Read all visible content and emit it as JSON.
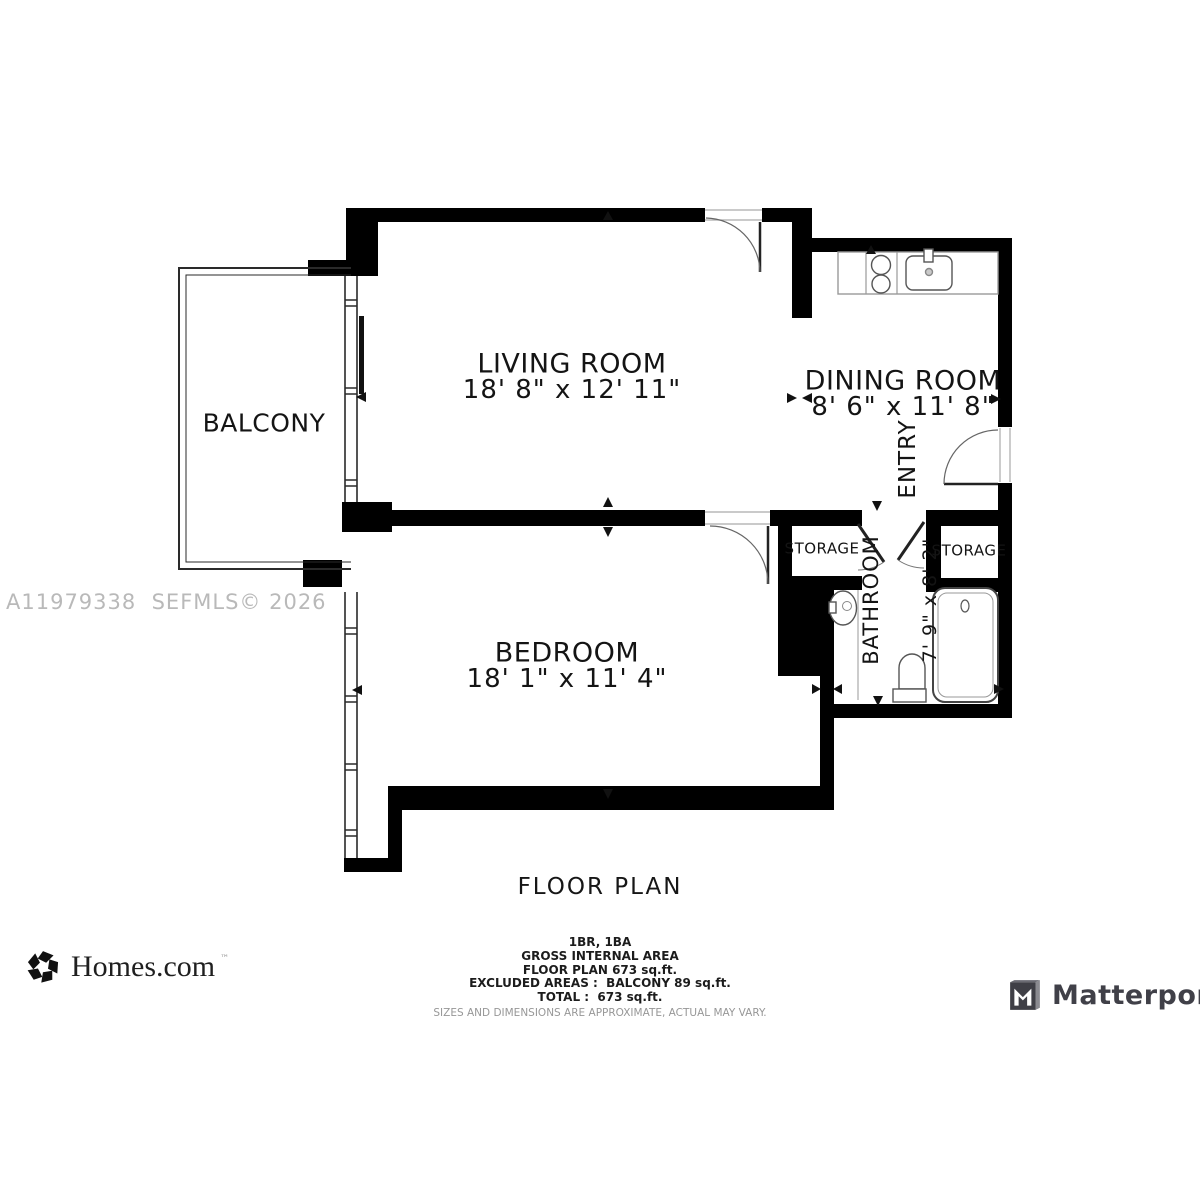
{
  "watermark": "A11979338  SEFMLS© 2026",
  "plan": {
    "title": "FLOOR PLAN",
    "rooms": {
      "living": {
        "name": "LIVING ROOM",
        "dims": "18' 8\" x 12' 11\""
      },
      "dining": {
        "name": "DINING ROOM",
        "dims": "8' 6\" x 11' 8\""
      },
      "bedroom": {
        "name": "BEDROOM",
        "dims": "18' 1\" x 11' 4\""
      },
      "bathroom": {
        "name": "BATHROOM",
        "dims": "7' 9\" x 8' 2\""
      },
      "balcony": {
        "name": "BALCONY"
      },
      "entry": {
        "name": "ENTRY"
      },
      "storage_left": {
        "name": "STORAGE"
      },
      "storage_right": {
        "name": "STORAGE"
      }
    },
    "summary": {
      "beds_baths": "1BR, 1BA",
      "area_heading": "GROSS INTERNAL AREA",
      "floor_area": "FLOOR PLAN 673 sq.ft.",
      "excluded": "EXCLUDED AREAS :  BALCONY 89 sq.ft.",
      "total": "TOTAL :  673 sq.ft.",
      "disclaimer": "SIZES AND DIMENSIONS ARE APPROXIMATE, ACTUAL MAY VARY."
    }
  },
  "branding": {
    "homes": "Homes.com",
    "homes_tm": "™",
    "matterport": "Matterport"
  },
  "colors": {
    "wall": "#000000",
    "fixture_line": "#555555",
    "light_line": "#999999",
    "watermark": "#b9b9b9",
    "matterport_text": "#404048"
  }
}
